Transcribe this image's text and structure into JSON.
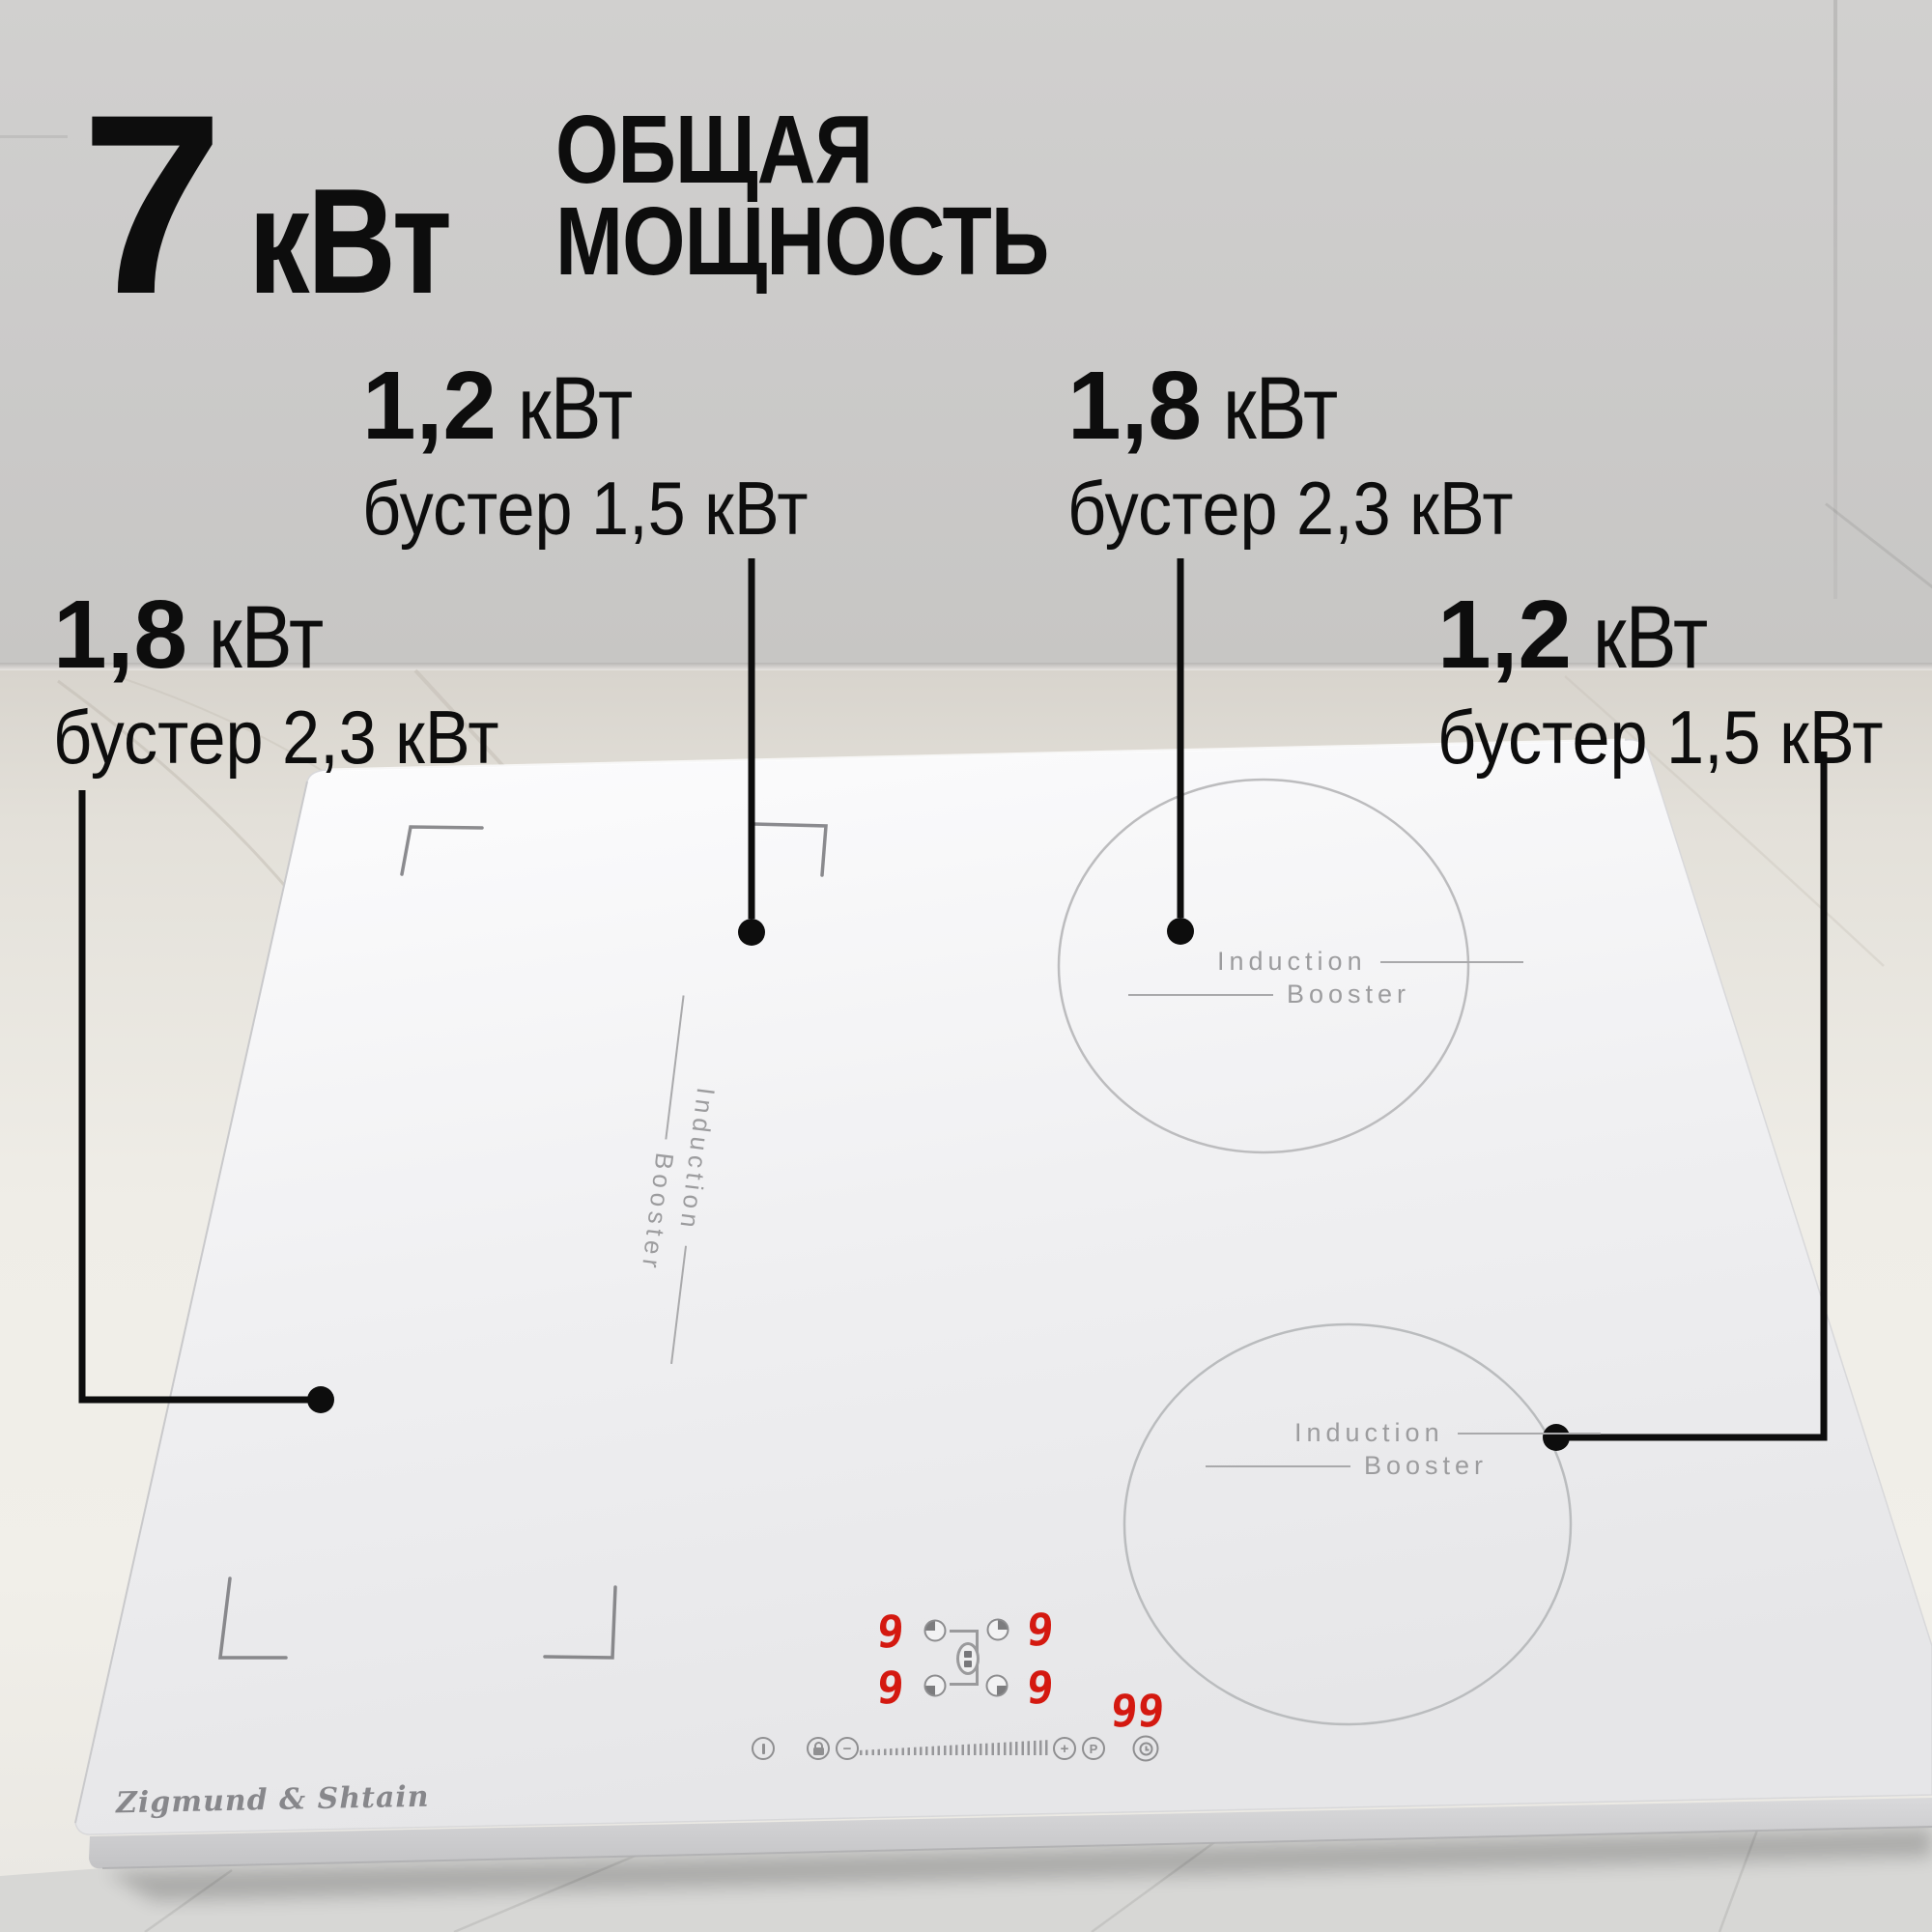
{
  "header": {
    "power_value": "7",
    "power_unit": "кВт",
    "title_line1": "ОБЩАЯ",
    "title_line2": "МОЩНОСТЬ"
  },
  "callouts": {
    "top_left": {
      "power": "1,2",
      "unit": "кВт",
      "booster": "бустер 1,5 кВт"
    },
    "top_right": {
      "power": "1,8",
      "unit": "кВт",
      "booster": "бустер 2,3 кВт"
    },
    "left": {
      "power": "1,8",
      "unit": "кВт",
      "booster": "бустер 2,3 кВт"
    },
    "right": {
      "power": "1,2",
      "unit": "кВт",
      "booster": "бустер 1,5 кВт"
    }
  },
  "cooktop": {
    "brand": "Zigmund & Shtain",
    "zone_label": {
      "line1": "Induction",
      "line2": "Booster"
    },
    "display": {
      "zone_top_left": "9",
      "zone_top_right": "9",
      "zone_bottom_left": "9",
      "zone_bottom_right": "9",
      "timer": "99"
    },
    "controls": {
      "minus": "−",
      "plus": "+",
      "program": "P"
    }
  },
  "colors": {
    "callout_text": "#0d0d0d",
    "display_red": "#d41910",
    "zone_label_gray": "#9c9c9e"
  }
}
